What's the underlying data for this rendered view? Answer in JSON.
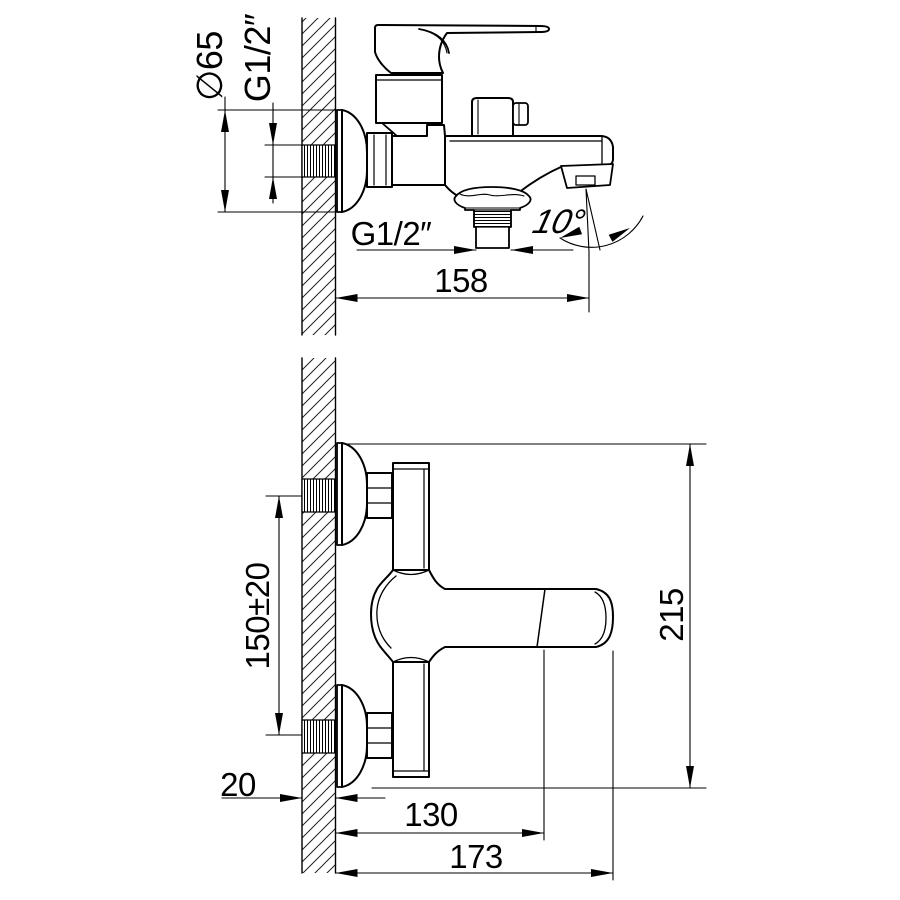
{
  "drawing": {
    "background": "#ffffff",
    "line_color": "#000000",
    "side_view": {
      "labels": {
        "flange_diameter": "∅65",
        "inlet_thread": "G1/2″",
        "shower_outlet_thread": "G1/2″",
        "spout_angle": "10°",
        "spout_reach": "158"
      }
    },
    "front_view": {
      "labels": {
        "mount_centers": "150±20",
        "overall_height": "215",
        "wall_thickness": "20",
        "reach_to_handle_grip": "130",
        "overall_reach": "173"
      }
    }
  }
}
